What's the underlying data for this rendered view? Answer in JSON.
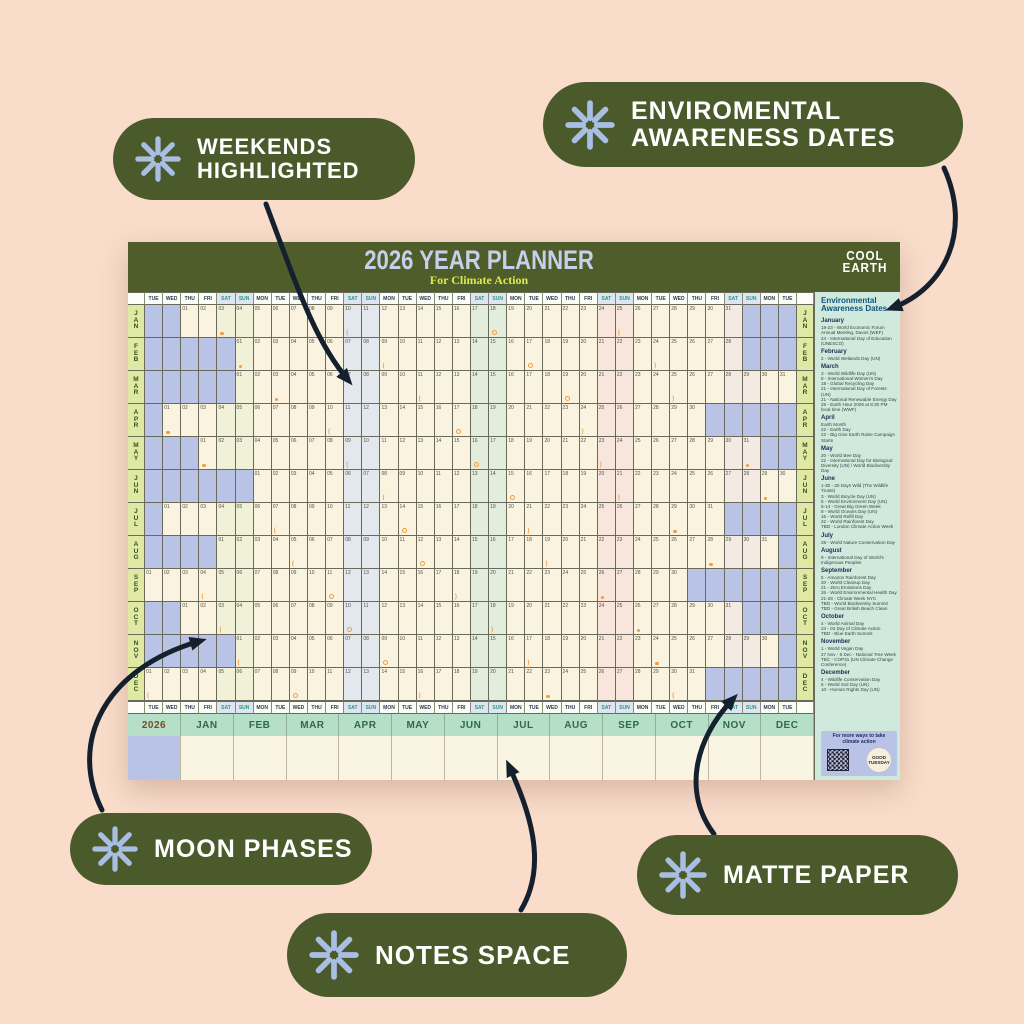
{
  "background_color": "#f9dcca",
  "accent_colors": {
    "pill_green": "#4b5a2a",
    "asterisk_periwinkle": "#a9bee3",
    "header_green": "#4f5d2b",
    "title_periwinkle": "#c6d0ed",
    "subtitle_yellow_green": "#dcea4e",
    "cream_cell": "#faf3e0",
    "lavender_empty": "#b9c3e6",
    "month_label_bg": "#dfe9a4",
    "mint_sidebar": "#cfeadc",
    "footer_band": "#b5dfc7",
    "moon_orange": "#f29d3a",
    "arrow_black": "#15202e"
  },
  "callouts": [
    {
      "lines": [
        "WEEKENDS",
        "HIGHLIGHTED"
      ]
    },
    {
      "lines": [
        "ENVIROMENTAL",
        "AWARENESS DATES"
      ]
    },
    {
      "lines": [
        "MOON PHASES"
      ]
    },
    {
      "lines": [
        "MATTE PAPER"
      ]
    },
    {
      "lines": [
        "NOTES SPACE"
      ]
    }
  ],
  "poster": {
    "title": "2026 YEAR PLANNER",
    "subtitle": "For Climate Action",
    "logo_line1": "COOL",
    "logo_line2": "EARTH",
    "year": "2026",
    "day_names": [
      "TUE",
      "WED",
      "THU",
      "FRI",
      "SAT",
      "SUN",
      "MON"
    ],
    "num_day_columns": 36,
    "weekend_tints": [
      "#f0f1d7",
      "#e3e7ee",
      "#e3eddd",
      "#f8e6dd",
      "#f5e9e4",
      "#faf3e0"
    ],
    "months": [
      {
        "abbr": "JAN",
        "days": 31,
        "offset": 2
      },
      {
        "abbr": "FEB",
        "days": 28,
        "offset": 5
      },
      {
        "abbr": "MAR",
        "days": 31,
        "offset": 5
      },
      {
        "abbr": "APR",
        "days": 30,
        "offset": 1
      },
      {
        "abbr": "MAY",
        "days": 31,
        "offset": 3
      },
      {
        "abbr": "JUN",
        "days": 30,
        "offset": 6
      },
      {
        "abbr": "JUL",
        "days": 31,
        "offset": 1
      },
      {
        "abbr": "AUG",
        "days": 31,
        "offset": 4
      },
      {
        "abbr": "SEP",
        "days": 30,
        "offset": 0
      },
      {
        "abbr": "OCT",
        "days": 31,
        "offset": 2
      },
      {
        "abbr": "NOV",
        "days": 30,
        "offset": 5
      },
      {
        "abbr": "DEC",
        "days": 31,
        "offset": 0
      }
    ],
    "moon_phases": [
      {
        "m": 0,
        "d": 3,
        "p": "full"
      },
      {
        "m": 0,
        "d": 10,
        "p": "lq"
      },
      {
        "m": 0,
        "d": 18,
        "p": "new"
      },
      {
        "m": 0,
        "d": 25,
        "p": "fq"
      },
      {
        "m": 1,
        "d": 1,
        "p": "full"
      },
      {
        "m": 1,
        "d": 9,
        "p": "lq"
      },
      {
        "m": 1,
        "d": 17,
        "p": "new"
      },
      {
        "m": 1,
        "d": 24,
        "p": "fq"
      },
      {
        "m": 2,
        "d": 3,
        "p": "full"
      },
      {
        "m": 2,
        "d": 11,
        "p": "lq"
      },
      {
        "m": 2,
        "d": 19,
        "p": "new"
      },
      {
        "m": 2,
        "d": 25,
        "p": "fq"
      },
      {
        "m": 3,
        "d": 1,
        "p": "full"
      },
      {
        "m": 3,
        "d": 10,
        "p": "lq"
      },
      {
        "m": 3,
        "d": 17,
        "p": "new"
      },
      {
        "m": 3,
        "d": 24,
        "p": "fq"
      },
      {
        "m": 4,
        "d": 1,
        "p": "full"
      },
      {
        "m": 4,
        "d": 9,
        "p": "lq"
      },
      {
        "m": 4,
        "d": 16,
        "p": "new"
      },
      {
        "m": 4,
        "d": 23,
        "p": "fq"
      },
      {
        "m": 4,
        "d": 31,
        "p": "full"
      },
      {
        "m": 5,
        "d": 8,
        "p": "lq"
      },
      {
        "m": 5,
        "d": 15,
        "p": "new"
      },
      {
        "m": 5,
        "d": 21,
        "p": "fq"
      },
      {
        "m": 5,
        "d": 29,
        "p": "full"
      },
      {
        "m": 6,
        "d": 7,
        "p": "lq"
      },
      {
        "m": 6,
        "d": 14,
        "p": "new"
      },
      {
        "m": 6,
        "d": 21,
        "p": "fq"
      },
      {
        "m": 6,
        "d": 29,
        "p": "full"
      },
      {
        "m": 7,
        "d": 5,
        "p": "lq"
      },
      {
        "m": 7,
        "d": 12,
        "p": "new"
      },
      {
        "m": 7,
        "d": 19,
        "p": "fq"
      },
      {
        "m": 7,
        "d": 28,
        "p": "full"
      },
      {
        "m": 8,
        "d": 4,
        "p": "lq"
      },
      {
        "m": 8,
        "d": 11,
        "p": "new"
      },
      {
        "m": 8,
        "d": 18,
        "p": "fq"
      },
      {
        "m": 8,
        "d": 26,
        "p": "full"
      },
      {
        "m": 9,
        "d": 3,
        "p": "lq"
      },
      {
        "m": 9,
        "d": 10,
        "p": "new"
      },
      {
        "m": 9,
        "d": 18,
        "p": "fq"
      },
      {
        "m": 9,
        "d": 26,
        "p": "full"
      },
      {
        "m": 10,
        "d": 1,
        "p": "lq"
      },
      {
        "m": 10,
        "d": 9,
        "p": "new"
      },
      {
        "m": 10,
        "d": 17,
        "p": "fq"
      },
      {
        "m": 10,
        "d": 24,
        "p": "full"
      },
      {
        "m": 11,
        "d": 1,
        "p": "lq"
      },
      {
        "m": 11,
        "d": 9,
        "p": "new"
      },
      {
        "m": 11,
        "d": 16,
        "p": "fq"
      },
      {
        "m": 11,
        "d": 23,
        "p": "full"
      },
      {
        "m": 11,
        "d": 30,
        "p": "lq"
      }
    ]
  },
  "sidebar": {
    "title": "Environmental Awareness Dates",
    "sections": [
      {
        "month": "January",
        "entries": [
          "19-23 - World Economic Forum Annual Meeting, Davos (WEF)",
          "24 - International Day of Education (UNESCO)"
        ]
      },
      {
        "month": "February",
        "entries": [
          "2 - World Wetlands Day (UN)"
        ]
      },
      {
        "month": "March",
        "entries": [
          "3 - World Wildlife Day (UN)",
          "8 - International Women's Day",
          "18 - Global Recycling Day",
          "21 - International Day of Forests (UN)",
          "21 - National Renewable Energy Day",
          "28 - Earth Hour 2026 at 8:30 PM local time (WWF)"
        ]
      },
      {
        "month": "April",
        "entries": [
          "Earth Month",
          "22 - Earth Day",
          "22 - Big Give Earth Raise Campaign Starts"
        ]
      },
      {
        "month": "May",
        "entries": [
          "20 - World Bee Day",
          "22 - International Day for Biological Diversity (UN) / World Biodiversity Day"
        ]
      },
      {
        "month": "June",
        "entries": [
          "1-30 - 30 Days Wild (The Wildlife Trusts)",
          "3 - World Bicycle Day (UN)",
          "5 - World Environment Day (UN)",
          "6-14 - Great Big Green Week",
          "8 - World Oceans Day (UN)",
          "16 - World Refill Day",
          "22 - World Rainforest Day",
          "TBD - London Climate Action Week"
        ]
      },
      {
        "month": "July",
        "entries": [
          "28 - World Nature Conservation Day"
        ]
      },
      {
        "month": "August",
        "entries": [
          "9 - International Day of World's Indigenous Peoples"
        ]
      },
      {
        "month": "September",
        "entries": [
          "5 - Amazon Rainforest Day",
          "20 - World Cleanup Day",
          "21 - Zero Emissions Day",
          "26 - World Environmental Health Day",
          "21-28 - Climate Week NYC",
          "TBD - World Biodiversity Summit",
          "TBD - Great British Beach Clean"
        ]
      },
      {
        "month": "October",
        "entries": [
          "4 - World Animal Day",
          "24 - Int Day of Climate Action",
          "TBD - Blue Earth Summit"
        ]
      },
      {
        "month": "November",
        "entries": [
          "1 - World Vegan Day",
          "27 Nov - 6 Dec - National Tree Week",
          "TBC - COP31 (UN Climate Change Conference)"
        ]
      },
      {
        "month": "December",
        "entries": [
          "4 - Wildlife Conservation Day",
          "5 - World Soil Day (UN)",
          "10 - Human Rights Day (UN)"
        ]
      }
    ],
    "footer_text": "For more ways to take climate action",
    "footer_logo": "GOOD TUESDAY"
  }
}
